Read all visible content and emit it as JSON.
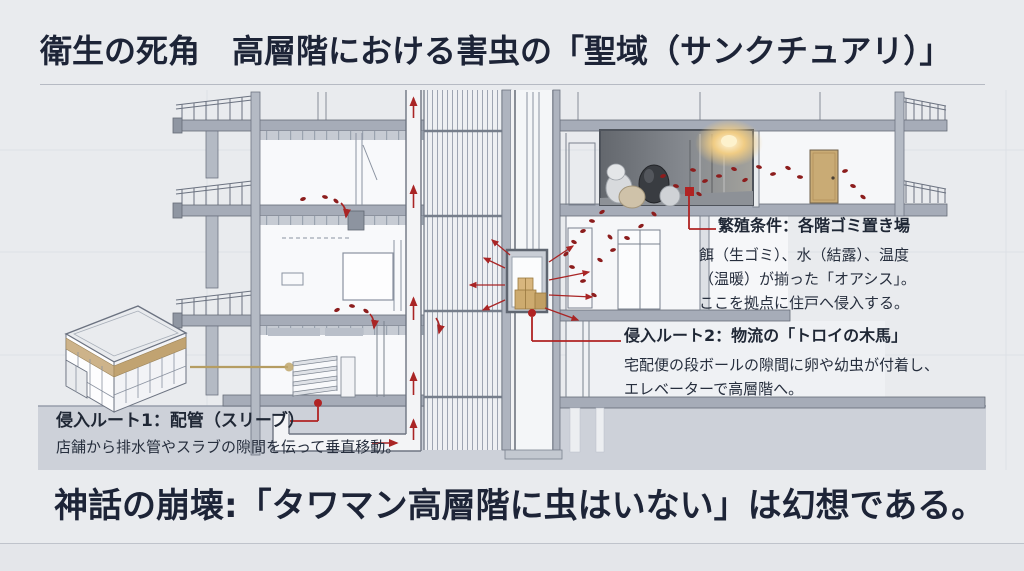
{
  "header": {
    "title": "衛生の死角　高層階における害虫の「聖域（サンクチュアリ）」"
  },
  "annotations": {
    "breeding": {
      "title": "繁殖条件：各階ゴミ置き場",
      "body": "餌（生ゴミ）、水（結露）、温度\n（温暖）が揃った「オアシス」。\nここを拠点に住戸へ侵入する。"
    },
    "route2": {
      "title": "侵入ルート2：物流の「トロイの木馬」",
      "body": "宅配便の段ボールの隙間に卵や幼虫が付着し、\nエレベーターで高層階へ。"
    },
    "route1": {
      "title": "侵入ルート1：配管（スリーブ）",
      "body": "店舗から排水管やスラブの隙間を伝って垂直移動。"
    }
  },
  "footer": {
    "headline": "神話の崩壊:「タワマン高層階に虫はいない」は幻想である。"
  },
  "diagram_elements": {
    "garbage_room": "各階ゴミ置き場（ゴミ袋・照明）",
    "elevator": "エレベーター（段ボール箱）",
    "pipe": "排水管（スリーブ）",
    "store": "店舗（低層テナント）"
  },
  "colors": {
    "accent_red": "#a92525",
    "insect_red": "#8c1d1d",
    "navy_text": "#1d2437",
    "tan": "#c9ab75",
    "slab_gray": "#a6acb8",
    "ground_gray": "#cdd1d9",
    "background": "#e9ebee"
  }
}
